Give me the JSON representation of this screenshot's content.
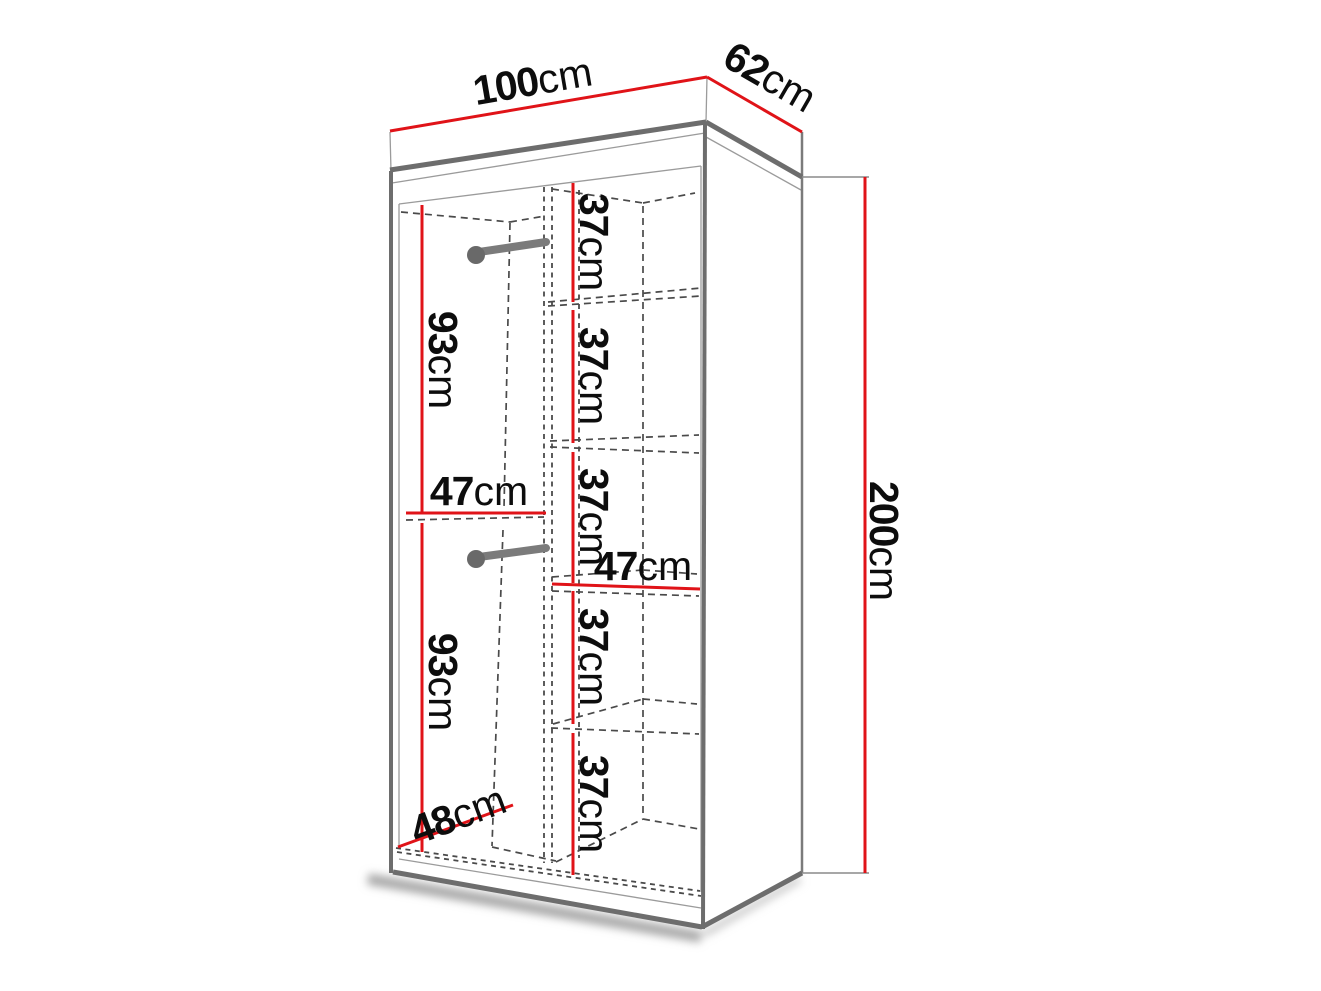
{
  "diagram": {
    "dimensions": {
      "width": {
        "value": "100",
        "unit": "cm"
      },
      "depth": {
        "value": "62",
        "unit": "cm"
      },
      "height": {
        "value": "200",
        "unit": "cm"
      },
      "hanging_upper": {
        "value": "93",
        "unit": "cm"
      },
      "hanging_lower": {
        "value": "93",
        "unit": "cm"
      },
      "left_width": {
        "value": "47",
        "unit": "cm"
      },
      "right_width": {
        "value": "47",
        "unit": "cm"
      },
      "interior_depth": {
        "value": "48",
        "unit": "cm"
      },
      "shelf_gaps": [
        {
          "value": "37",
          "unit": "cm"
        },
        {
          "value": "37",
          "unit": "cm"
        },
        {
          "value": "37",
          "unit": "cm"
        },
        {
          "value": "37",
          "unit": "cm"
        },
        {
          "value": "37",
          "unit": "cm"
        }
      ]
    },
    "colors": {
      "dimension_line": "#e01318",
      "edge": "#6d6d6d",
      "dashed": "#4a4a4a",
      "rail": "#7b7b7b",
      "text": "#0d0d0d"
    }
  }
}
